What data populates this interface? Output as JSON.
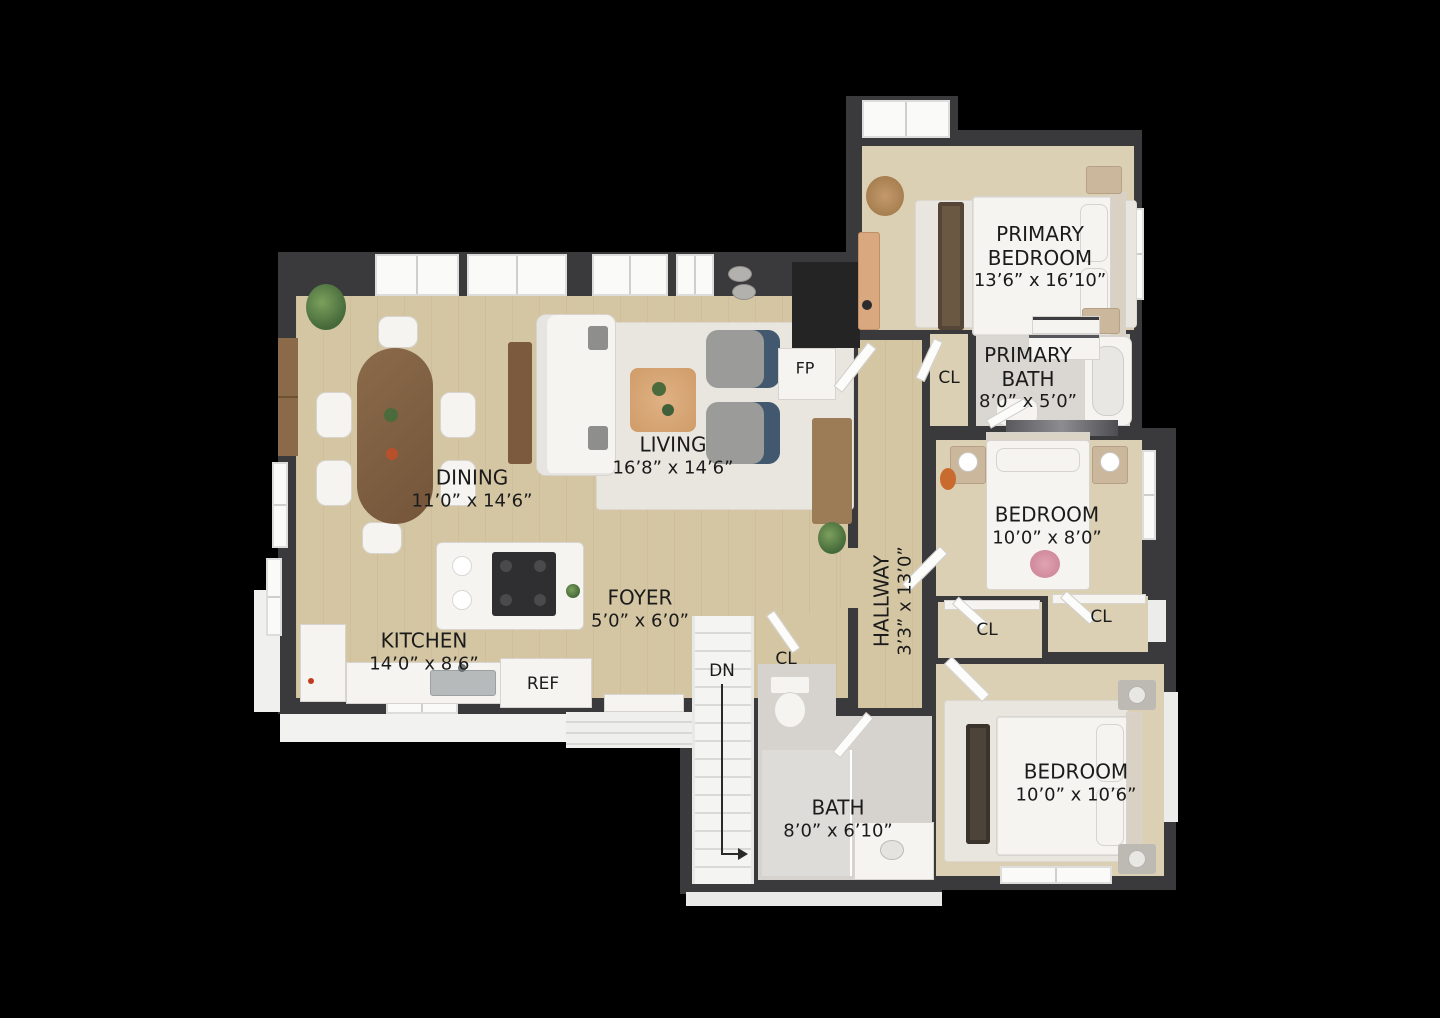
{
  "title": "3D Floor Plan",
  "rooms": {
    "dining": {
      "name": "DINING",
      "dims": "11’0” x 14’6”"
    },
    "living": {
      "name": "LIVING",
      "dims": "16’8” x 14’6”"
    },
    "kitchen": {
      "name": "KITCHEN",
      "dims": "14’0” x 8’6”"
    },
    "foyer": {
      "name": "FOYER",
      "dims": "5’0” x 6’0”"
    },
    "hallway": {
      "name": "HALLWAY",
      "dims": "3’3” x 13’0”"
    },
    "primary_bedroom": {
      "name": "PRIMARY BEDROOM",
      "dims": "13’6” x 16’10”"
    },
    "primary_bath": {
      "name": "PRIMARY BATH",
      "dims": "8’0” x 5’0”"
    },
    "bedroom_mid": {
      "name": "BEDROOM",
      "dims": "10’0” x 8’0”"
    },
    "bedroom_lower": {
      "name": "BEDROOM",
      "dims": "10’0” x 10’6”"
    },
    "bath": {
      "name": "BATH",
      "dims": "8’0” x 6’10”"
    }
  },
  "markers": {
    "closet": "CL",
    "refrigerator": "REF",
    "fireplace": "FP",
    "stairs_down": "DN"
  },
  "colors": {
    "background": "#000000",
    "wall": "#3a3a3c",
    "floor-wood": "#d5c6a3",
    "floor-carpet": "#dbcfb4",
    "floor-tile": "#d6d3ce",
    "rug": "#e9e6e0",
    "furniture-white": "#f5f4f1",
    "wood-dark": "#8a6a49",
    "accent-blue": "#41586f",
    "label": "#1b1b1b"
  }
}
